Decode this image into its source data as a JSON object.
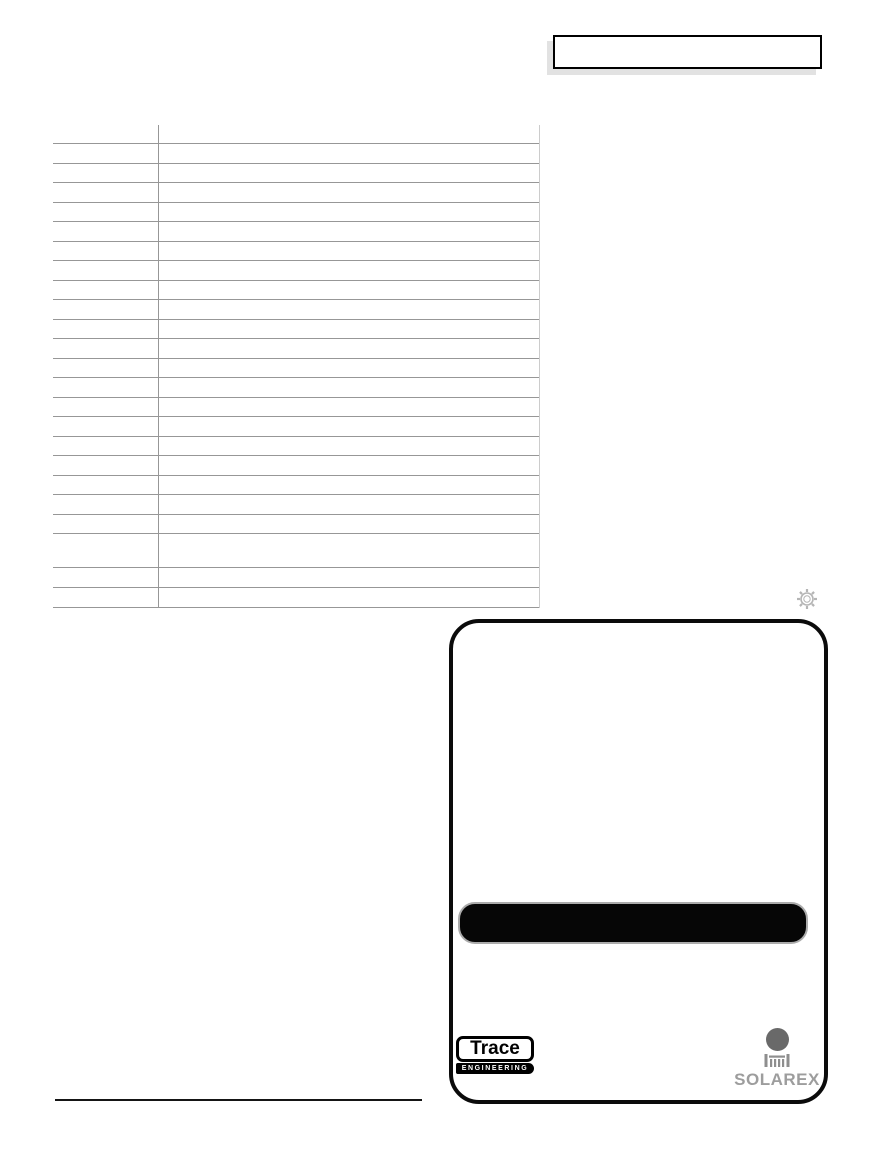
{
  "logos": {
    "trace": {
      "name": "Trace",
      "tagline": "ENGINEERING"
    },
    "solarex": {
      "name": "SOLAREX"
    }
  },
  "spec_table": {
    "row_count": 24,
    "column_count": 2
  },
  "colors": {
    "table_line": "#979797",
    "table_right_edge": "#cccccc",
    "titlebox_shadow": "#e2e2e2",
    "panel_border": "#0b0b0b",
    "model_bar_fill": "#060606",
    "model_bar_outline": "#ababab",
    "sun_icon": "#b5b5b5",
    "solarex_gray": "#8e8e8e",
    "solarex_text": "#9d9d9d"
  }
}
